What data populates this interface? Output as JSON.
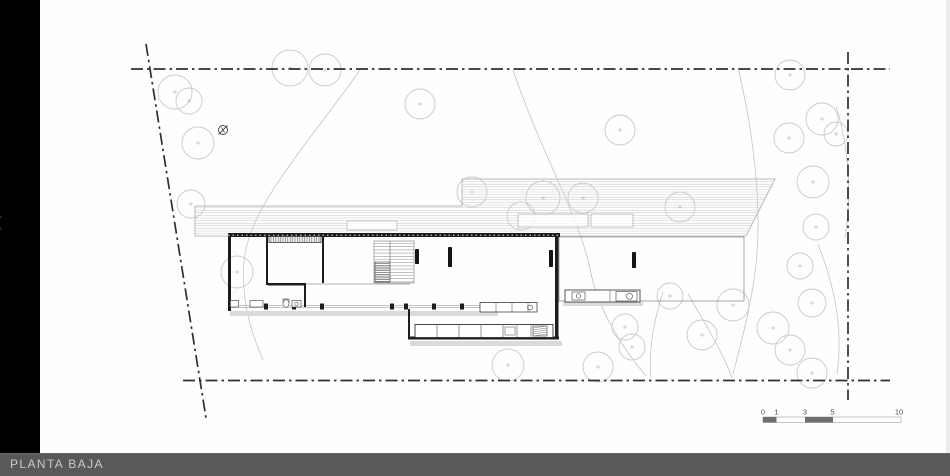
{
  "viewer": {
    "footer_label": "PLANTA BAJA",
    "prev_glyph": "‹",
    "colors": {
      "sidebar": "#010101",
      "footer_bar": "#595959",
      "footer_text": "#c9c9c9",
      "canvas": "#fefefe",
      "boundary_line": "#2f2f2f",
      "wall": "#1c1c1c",
      "tree_stroke": "#c9c9c9",
      "contour_stroke": "#c4c4c4",
      "roof_hatch": "#cacaca",
      "shadow": "#dadada",
      "scale_dark": "#6e6e6e"
    }
  },
  "plan": {
    "boundary_lines": [
      {
        "x1": 131,
        "y1": 69,
        "x2": 890,
        "y2": 69
      },
      {
        "x1": 146,
        "y1": 44,
        "x2": 206,
        "y2": 418
      },
      {
        "x1": 183,
        "y1": 380.5,
        "x2": 890,
        "y2": 380.5
      },
      {
        "x1": 848,
        "y1": 52,
        "x2": 848,
        "y2": 400
      }
    ],
    "trees": [
      [
        175,
        92,
        17
      ],
      [
        189,
        101,
        13
      ],
      [
        198,
        143,
        16
      ],
      [
        191,
        204,
        14
      ],
      [
        237,
        272,
        16
      ],
      [
        290,
        68,
        18
      ],
      [
        325,
        70,
        16
      ],
      [
        420,
        104,
        15
      ],
      [
        620,
        130,
        15
      ],
      [
        472,
        192,
        15
      ],
      [
        521,
        216,
        14
      ],
      [
        543,
        198,
        17
      ],
      [
        583,
        198,
        15
      ],
      [
        680,
        207,
        15
      ],
      [
        790,
        75,
        15
      ],
      [
        822,
        119,
        16
      ],
      [
        836,
        134,
        12
      ],
      [
        789,
        138,
        15
      ],
      [
        813,
        182,
        16
      ],
      [
        816,
        227,
        13
      ],
      [
        800,
        266,
        13
      ],
      [
        812,
        303,
        14
      ],
      [
        733,
        305,
        16
      ],
      [
        773,
        328,
        16
      ],
      [
        790,
        350,
        15
      ],
      [
        812,
        373,
        15
      ],
      [
        625,
        327,
        13
      ],
      [
        632,
        347,
        13
      ],
      [
        702,
        335,
        15
      ],
      [
        670,
        296,
        13
      ],
      [
        598,
        367,
        15
      ],
      [
        508,
        365,
        16
      ]
    ],
    "contours": [
      "M360,70 C305,148 248,208 244,262 C241,303 252,334 263,360",
      "M513,70 C540,150 576,210 589,264 C597,309 621,346 646,376",
      "M738,68 C753,130 761,198 757,254 C753,299 743,336 733,374",
      "M836,106 C849,148 852,194 845,238",
      "M818,244 C836,290 843,330 837,374",
      "M663,292 C654,320 648,350 651,378",
      "M688,294 C704,322 722,350 732,378"
    ],
    "roof": {
      "outline": "195,206 462,206 462,179 775,179 746,236 195,236",
      "hatch_top": 179,
      "hatch_bottom": 236,
      "hatch_left": 195,
      "hatch_right": 776,
      "hatch_step": 2.6,
      "skylights": [
        [
          518,
          214,
          70,
          13
        ],
        [
          591,
          214,
          42,
          13
        ],
        [
          347,
          221,
          50,
          9
        ]
      ]
    },
    "terrace": {
      "x": 559,
      "y": 237,
      "w": 185,
      "h": 64
    },
    "shadows": [
      [
        230,
        311,
        268,
        5
      ],
      [
        410,
        341,
        152,
        5
      ],
      [
        563,
        302,
        80,
        4
      ]
    ],
    "walls": [
      [
        228,
        233,
        332,
        4
      ],
      [
        228,
        233,
        3,
        78
      ],
      [
        555,
        237,
        3.5,
        101
      ],
      [
        408,
        336.5,
        151,
        3
      ],
      [
        408,
        309,
        2,
        29
      ],
      [
        266,
        237,
        2,
        48
      ],
      [
        322,
        233,
        2,
        50
      ],
      [
        268,
        283,
        38,
        2.5
      ],
      [
        304,
        285,
        2,
        22
      ]
    ],
    "glazing": {
      "x1": 228,
      "x2": 493,
      "y": 306.5,
      "posts": [
        266,
        294,
        322,
        392,
        406,
        434,
        462,
        488
      ]
    },
    "wardrobe": [
      269,
      236.5,
      52,
      6
    ],
    "stair": {
      "x": 374,
      "y": 241,
      "w": 40,
      "h": 42,
      "tread_step": 3.2,
      "dense": [
        375,
        262,
        15,
        20
      ]
    },
    "columns": [
      [
        415,
        249,
        4,
        15
      ],
      [
        448,
        247,
        4,
        20
      ],
      [
        549,
        250,
        4,
        17
      ],
      [
        632,
        252,
        4,
        16
      ]
    ],
    "island": {
      "rect": [
        415,
        324.5,
        138,
        13
      ],
      "dividers": [
        437,
        459,
        481,
        503,
        517,
        531
      ],
      "appliance": [
        533,
        326,
        14,
        10
      ],
      "small_box": [
        505,
        327,
        10,
        8
      ]
    },
    "counter_a": {
      "rect": [
        480,
        302.5,
        57,
        9.5
      ],
      "dividers": [
        496,
        512,
        528
      ],
      "knob": [
        530,
        307.5,
        2.4
      ]
    },
    "outdoor_counter": {
      "rect": [
        565,
        290,
        75,
        12
      ],
      "sink_box": [
        572,
        292,
        13,
        8
      ],
      "sink_knob": [
        578.5,
        296,
        2.2
      ],
      "appliance": [
        616,
        291.5,
        21,
        9.5
      ],
      "appliance_knob": [
        629.5,
        296.3,
        3
      ],
      "divider_x": 610
    },
    "fixtures": {
      "rects": [
        [
          230.5,
          300.5,
          8,
          6.5
        ],
        [
          250,
          300.5,
          13,
          6.5
        ],
        [
          292,
          300.5,
          9,
          6.5
        ],
        [
          283,
          299,
          6,
          3
        ]
      ],
      "ellipse": [
        286,
        303.5,
        3,
        3.8
      ],
      "circles": [
        [
          296.5,
          304,
          1.8
        ]
      ]
    },
    "floor_line": {
      "x1": 306,
      "y1": 284,
      "x2": 410,
      "y2": 284
    },
    "north_symbol": {
      "cx": 223,
      "cy": 130,
      "r": 4.5
    },
    "scale_bar": {
      "labels": [
        {
          "t": "0",
          "x": 763
        },
        {
          "t": "1",
          "x": 776.5
        },
        {
          "t": "3",
          "x": 805
        },
        {
          "t": "5",
          "x": 832.5
        },
        {
          "t": "10",
          "x": 899
        }
      ],
      "label_y": 414.5,
      "bar": {
        "x": 763,
        "y": 417,
        "w": 138,
        "h": 5.5
      },
      "dark_segments": [
        [
          763,
          13.5
        ],
        [
          805,
          28
        ]
      ]
    }
  }
}
